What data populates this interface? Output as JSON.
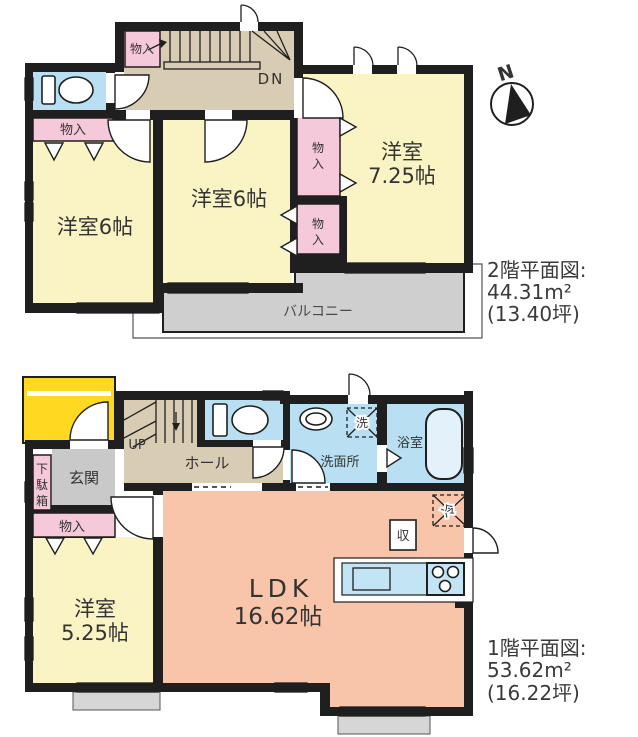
{
  "compass": {
    "north_label": "N"
  },
  "floor2": {
    "title_line1": "2階平面図:",
    "title_line2": "44.31m²",
    "title_line3": "(13.40坪)",
    "rooms": {
      "closet_top": "物入",
      "closet_left": "物入",
      "closet_mid_upper_chars": [
        "物",
        "入"
      ],
      "closet_mid_lower_chars": [
        "物",
        "入"
      ],
      "stairs_dn": "DN",
      "room_left": "洋室6帖",
      "room_middle": "洋室6帖",
      "room_right_line1": "洋室",
      "room_right_line2": "7.25帖",
      "balcony": "バルコニー"
    }
  },
  "floor1": {
    "title_line1": "1階平面図:",
    "title_line2": "53.62m²",
    "title_line3": "(16.22坪)",
    "rooms": {
      "stairs_up": "UP",
      "hall": "ホール",
      "entrance": "玄関",
      "shoe_cabinet_chars": [
        "下",
        "駄",
        "箱"
      ],
      "closet": "物入",
      "room_line1": "洋室",
      "room_line2": "5.25帖",
      "ldk_line1": "LDK",
      "ldk_line2": "16.62帖",
      "washroom": "洗面所",
      "washer": "洗",
      "bathroom": "浴室",
      "storage": "収",
      "fridge": "冷"
    }
  }
}
